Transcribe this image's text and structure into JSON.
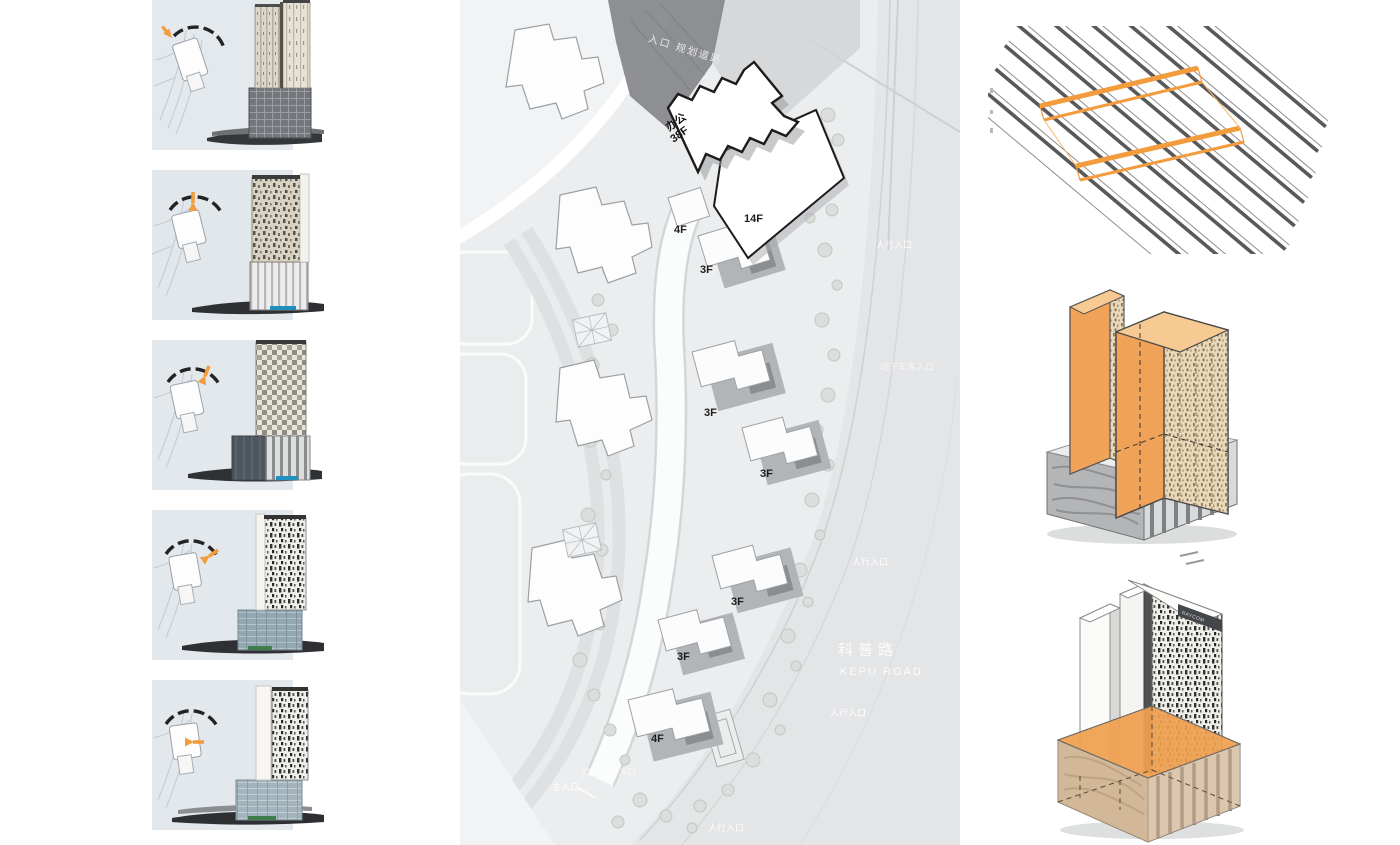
{
  "meta": {
    "accent_orange": "#F39C3D",
    "plan_bg": "#ECEDEE",
    "shadow_gray": "#87898C"
  },
  "left_panel": {
    "steps": [
      {
        "name": "massing-step-1",
        "icon": "rotate-arrow-icon"
      },
      {
        "name": "massing-step-2",
        "icon": "rotate-arrow-icon"
      },
      {
        "name": "massing-step-3",
        "icon": "rotate-arrow-icon"
      },
      {
        "name": "massing-step-4",
        "icon": "rotate-arrow-icon"
      },
      {
        "name": "massing-step-5",
        "icon": "rotate-arrow-icon"
      }
    ]
  },
  "site_plan": {
    "top_road_label": "入口 规划道路",
    "tower": {
      "use": "办公",
      "floors": "38F"
    },
    "podium_floors": "14F",
    "floor_labels": {
      "f4_top": "4F",
      "f3_1": "3F",
      "f3_2": "3F",
      "f3_3": "3F",
      "f3_4": "3F",
      "f3_5": "3F",
      "f4_bottom": "4F"
    },
    "road": {
      "cn": "科普路",
      "en": "KEPU ROAD"
    },
    "entrances": {
      "pedestrian": "人行入口",
      "main": "主入口",
      "garage": "地下车库入口"
    }
  },
  "right_panel": {
    "diagrams": [
      {
        "name": "facade-plank-pattern-diagram"
      },
      {
        "name": "tower-slabs-axon"
      },
      {
        "name": "podium-volume-axon",
        "signage": "RAYCOM"
      }
    ]
  }
}
